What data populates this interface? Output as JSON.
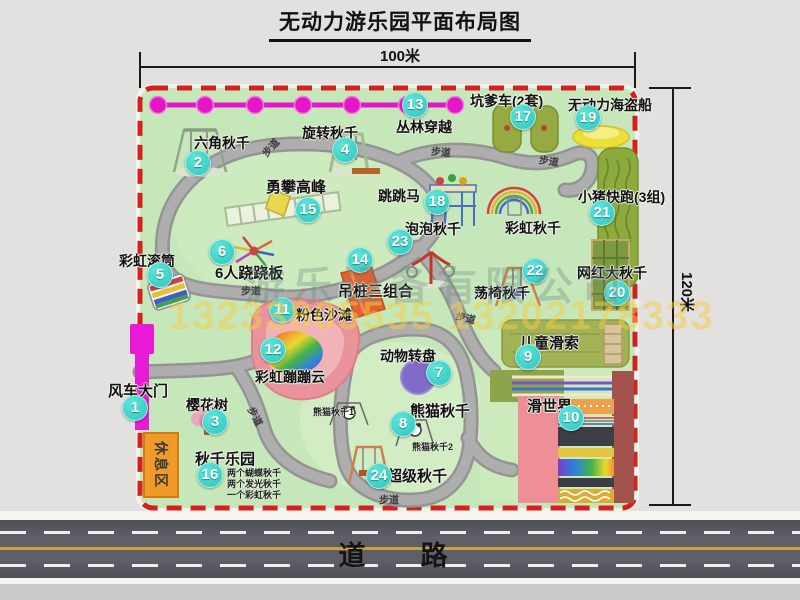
{
  "title": "无动力游乐园平面布局图",
  "dimension_labels": {
    "top": "100米",
    "right": "120米"
  },
  "road": {
    "label": "道　路"
  },
  "watermark": {
    "company": "游乐设备有限公司",
    "phone": "13233805535 13202178333"
  },
  "map": {
    "rest_area_label": "休息区",
    "walkway_label": "步道",
    "attractions": [
      {
        "num": "1",
        "name": "风车大门",
        "label": {
          "x": 108,
          "y": 380,
          "fs": 15
        },
        "badge": {
          "x": 135,
          "y": 408
        }
      },
      {
        "num": "2",
        "name": "六角秋千",
        "label": {
          "x": 194,
          "y": 133,
          "fs": 14
        },
        "badge": {
          "x": 198,
          "y": 163
        }
      },
      {
        "num": "3",
        "name": "樱花树",
        "label": {
          "x": 186,
          "y": 395,
          "fs": 14
        },
        "badge": {
          "x": 215,
          "y": 422
        }
      },
      {
        "num": "4",
        "name": "旋转秋千",
        "label": {
          "x": 302,
          "y": 123,
          "fs": 14
        },
        "badge": {
          "x": 345,
          "y": 150
        }
      },
      {
        "num": "5",
        "name": "彩虹滚筒",
        "label": {
          "x": 119,
          "y": 251,
          "fs": 14
        },
        "badge": {
          "x": 160,
          "y": 275
        }
      },
      {
        "num": "6",
        "name": "6人跷跷板",
        "label": {
          "x": 215,
          "y": 262,
          "fs": 15
        },
        "badge": {
          "x": 222,
          "y": 252
        }
      },
      {
        "num": "7",
        "name": "动物转盘",
        "label": {
          "x": 380,
          "y": 346,
          "fs": 14
        },
        "badge": {
          "x": 439,
          "y": 373
        }
      },
      {
        "num": "8",
        "name": "熊猫秋千",
        "label": {
          "x": 410,
          "y": 400,
          "fs": 15
        },
        "badge": {
          "x": 403,
          "y": 424
        }
      },
      {
        "num": "9",
        "name": "儿童滑索",
        "label": {
          "x": 519,
          "y": 332,
          "fs": 15
        },
        "badge": {
          "x": 528,
          "y": 357
        }
      },
      {
        "num": "10",
        "name": "滑世界",
        "label": {
          "x": 527,
          "y": 395,
          "fs": 15
        },
        "badge": {
          "x": 571,
          "y": 418
        }
      },
      {
        "num": "11",
        "name": "粉色沙滩",
        "label": {
          "x": 296,
          "y": 305,
          "fs": 14
        },
        "badge": {
          "x": 282,
          "y": 310
        }
      },
      {
        "num": "12",
        "name": "彩虹蹦蹦云",
        "label": {
          "x": 255,
          "y": 367,
          "fs": 14
        },
        "badge": {
          "x": 273,
          "y": 350
        }
      },
      {
        "num": "13",
        "name": "丛林穿越",
        "label": {
          "x": 396,
          "y": 117,
          "fs": 14
        },
        "badge": {
          "x": 415,
          "y": 105
        }
      },
      {
        "num": "14",
        "name": "吊桩三组合",
        "label": {
          "x": 338,
          "y": 280,
          "fs": 15
        },
        "badge": {
          "x": 360,
          "y": 260
        }
      },
      {
        "num": "15",
        "name": "勇攀高峰",
        "label": {
          "x": 266,
          "y": 176,
          "fs": 15
        },
        "badge": {
          "x": 308,
          "y": 210
        }
      },
      {
        "num": "16",
        "name": "秋千乐园",
        "label": {
          "x": 195,
          "y": 448,
          "fs": 15
        },
        "badge": {
          "x": 210,
          "y": 475
        }
      },
      {
        "num": "17",
        "name": "坑爹车(2套)",
        "label": {
          "x": 470,
          "y": 91,
          "fs": 14
        },
        "badge": {
          "x": 523,
          "y": 117
        }
      },
      {
        "num": "18",
        "name": "跳跳马",
        "label": {
          "x": 378,
          "y": 186,
          "fs": 14
        },
        "badge": {
          "x": 437,
          "y": 202
        }
      },
      {
        "num": "19",
        "name": "无动力海盗船",
        "label": {
          "x": 568,
          "y": 95,
          "fs": 14
        },
        "badge": {
          "x": 588,
          "y": 118
        }
      },
      {
        "num": "20",
        "name": "网红大秋千",
        "label": {
          "x": 577,
          "y": 263,
          "fs": 14
        },
        "badge": {
          "x": 617,
          "y": 293
        }
      },
      {
        "num": "21",
        "name": "小猪快跑(3组)",
        "label": {
          "x": 578,
          "y": 187,
          "fs": 14
        },
        "badge": {
          "x": 602,
          "y": 213
        }
      },
      {
        "num": "22",
        "name": "荡椅秋千",
        "label": {
          "x": 474,
          "y": 283,
          "fs": 14
        },
        "badge": {
          "x": 535,
          "y": 271
        }
      },
      {
        "num": "23",
        "name": "泡泡秋千",
        "label": {
          "x": 405,
          "y": 219,
          "fs": 14
        },
        "badge": {
          "x": 400,
          "y": 242
        }
      },
      {
        "num": "24",
        "name": "超级秋千",
        "label": {
          "x": 387,
          "y": 465,
          "fs": 15
        },
        "badge": {
          "x": 379,
          "y": 476
        }
      },
      {
        "num": "",
        "name": "彩虹秋千",
        "label": {
          "x": 505,
          "y": 218,
          "fs": 14
        }
      }
    ],
    "sub_labels": [
      {
        "text": "熊猫秋千1",
        "x": 313,
        "y": 405
      },
      {
        "text": "熊猫秋千2",
        "x": 412,
        "y": 440
      },
      {
        "text": "两个蝴蝶秋千",
        "x": 227,
        "y": 466
      },
      {
        "text": "两个发光秋千",
        "x": 227,
        "y": 477
      },
      {
        "text": "一个彩虹秋千",
        "x": 227,
        "y": 488
      }
    ],
    "path_labels": [
      {
        "x": 270,
        "y": 147,
        "rot": -48
      },
      {
        "x": 441,
        "y": 151,
        "rot": 4
      },
      {
        "x": 549,
        "y": 160,
        "rot": 8
      },
      {
        "x": 251,
        "y": 290,
        "rot": 0
      },
      {
        "x": 466,
        "y": 317,
        "rot": 14
      },
      {
        "x": 256,
        "y": 416,
        "rot": 62
      },
      {
        "x": 389,
        "y": 499,
        "rot": 0
      }
    ]
  },
  "colors": {
    "badge": "#2cc7bf",
    "border": "#d81f1f",
    "chain": "#e616c8",
    "map_bg": "#c6e7ba"
  }
}
